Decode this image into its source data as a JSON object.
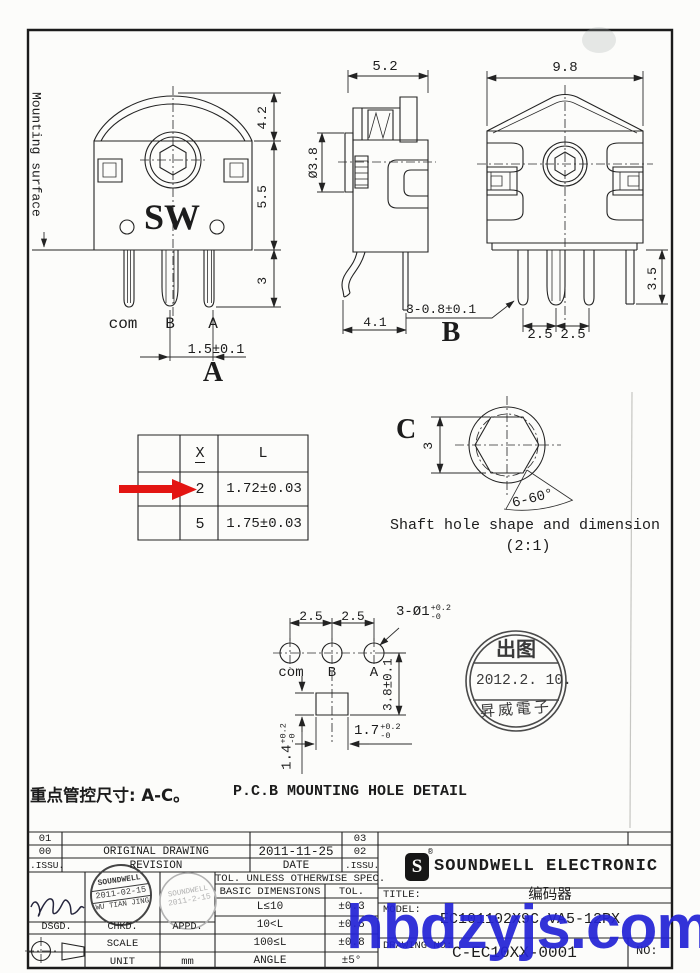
{
  "watermark": "hbdzyjs.com",
  "key_note": "重点管控尺寸: A-C。",
  "captions": {
    "pcb": "P.C.B MOUNTING HOLE DETAIL",
    "shaft": "Shaft hole shape and dimension",
    "shaft_scale": "(2:1)"
  },
  "views": {
    "a": {
      "label": "A",
      "logo": "SW",
      "mounting": "Mounting surface",
      "dim_dome": "4.2",
      "dim_body": "5.5",
      "dim_pin": "3",
      "dim_pitch": "1.5±0.1",
      "pin_com": "com",
      "pin_b": "B",
      "pin_a": "A"
    },
    "b": {
      "label": "B",
      "dim_width": "5.2",
      "dim_shaft": "Ø3.8",
      "dim_depth": "4.1",
      "dim_pins": "3-0.8±0.1"
    },
    "c": {
      "dim_width": "9.8",
      "dim_pinlen": "3.5",
      "dim_p1": "2.5",
      "dim_p2": "2.5"
    }
  },
  "xl_table": {
    "col_x": "X",
    "col_l": "L",
    "rows": [
      {
        "x": "2",
        "l": "1.72±0.03"
      },
      {
        "x": "5",
        "l": "1.75±0.03"
      }
    ]
  },
  "shaft_hole": {
    "label": "C",
    "dim_flat": "3",
    "angle": "6-60°"
  },
  "pcb": {
    "p1": "2.5",
    "p2": "2.5",
    "pin_com": "com",
    "pin_b": "B",
    "pin_a": "A",
    "callout": "3-Ø1",
    "callout_up": "+0.2",
    "callout_dn": "-0",
    "dim_v": "3.8±0.1",
    "dim_w": "1.7",
    "dim_w_up": "+0.2",
    "dim_w_dn": "-0",
    "dim_h": "1.4",
    "dim_h_up": "+0.2",
    "dim_h_dn": "-0"
  },
  "stamp": {
    "top": "出图",
    "date": "2012.2. 10.",
    "company": "昇威電子"
  },
  "revision_table": {
    "r1c1": "01",
    "r1c4": "03",
    "r2c1": "00",
    "r2c2": "ORIGINAL DRAWING",
    "r2c3": "2011-11-25",
    "r2c4": "02",
    "r3c1": ".ISSU.",
    "r3c2": "REVISION",
    "r3c3": "DATE",
    "r3c4": ".ISSU."
  },
  "signoff": {
    "dsgd": "DSGD.",
    "chkd": "CHKD.",
    "appd": "APPD.",
    "scale_label": "SCALE",
    "unit_label": "UNIT",
    "unit_value": "mm",
    "chkd_stamp_l1": "SOUNDWELL",
    "chkd_stamp_l2": "2011-02-15",
    "chkd_stamp_l3": "WU TIAN JING",
    "appd_stamp_l1": "SOUNDWELL",
    "appd_stamp_l2": "2011-2-15"
  },
  "tolerance_table": {
    "header": "TOL. UNLESS OTHERWISE SPEC.",
    "col_dim": "BASIC DIMENSIONS",
    "col_tol": "TOL.",
    "rows": [
      {
        "dim": "L≤10",
        "tol": "±0.3"
      },
      {
        "dim": "10<L",
        "tol": "±0.5"
      },
      {
        "dim": "100≤L",
        "tol": "±0.8"
      },
      {
        "dim": "ANGLE",
        "tol": "±5°"
      }
    ]
  },
  "title_block": {
    "company": "SOUNDWELL  ELECTRONIC",
    "logo_letter": "S",
    "reg": "®",
    "title_label": "TITLE:",
    "title_value": "编码器",
    "model_label": "MODEL:",
    "model_value": "EC101102X9C-VA5-12PX",
    "drawing_label": "DRAWING NO:",
    "drawing_value": "C-EC10XX-0001",
    "no_label": "NO:"
  }
}
